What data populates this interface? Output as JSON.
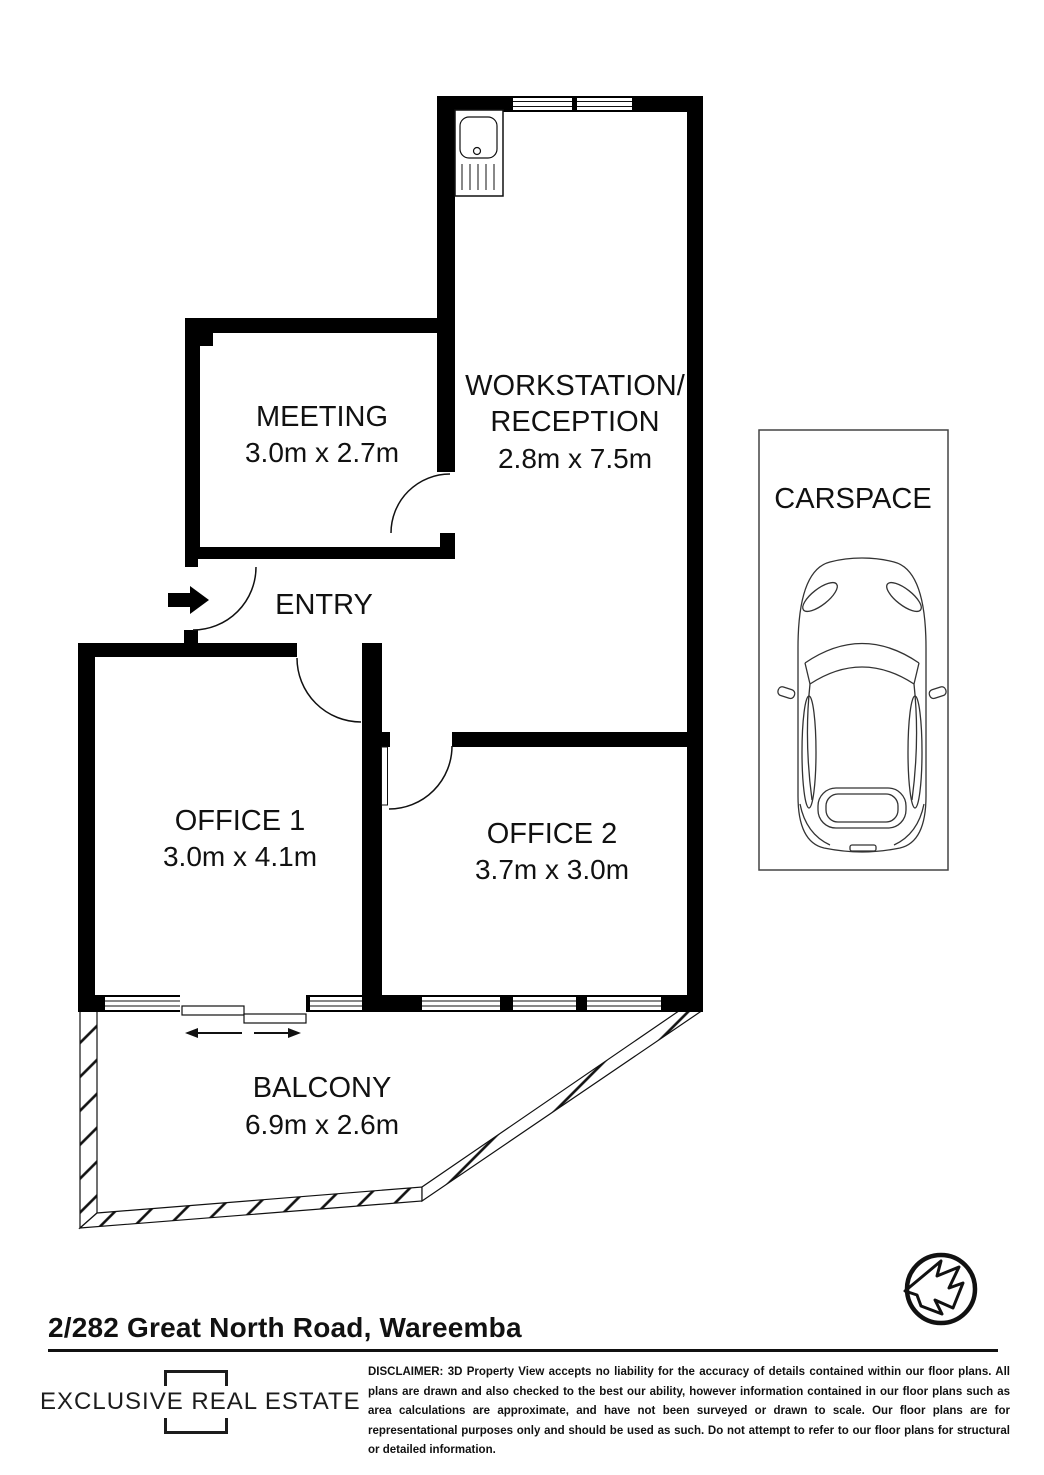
{
  "rooms": {
    "meeting": {
      "label": "MEETING",
      "dims": "3.0m x 2.7m"
    },
    "workstation": {
      "label_line1": "WORKSTATION/",
      "label_line2": "RECEPTION",
      "dims": "2.8m x 7.5m"
    },
    "entry": {
      "label": "ENTRY"
    },
    "office1": {
      "label": "OFFICE 1",
      "dims": "3.0m x 4.1m"
    },
    "office2": {
      "label": "OFFICE 2",
      "dims": "3.7m x 3.0m"
    },
    "balcony": {
      "label": "BALCONY",
      "dims": "6.9m x 2.6m"
    },
    "carspace": {
      "label": "CARSPACE"
    }
  },
  "icons": {
    "north_arrow": "north-arrow",
    "sink": "kitchen-sink",
    "car": "car-top-view",
    "entry_arrow": "entry-direction-arrow",
    "sliding_door_arrows": "sliding-door-direction-arrows"
  },
  "colors": {
    "ink": "#111111",
    "background": "#ffffff"
  },
  "footer": {
    "address": "2/282 Great North Road, Wareemba",
    "logo_text": "EXCLUSIVE REAL ESTATE",
    "disclaimer": "DISCLAIMER: 3D Property View accepts no liability for the accuracy of details contained within our floor plans. All plans are drawn and also checked to the best our ability, however information contained in our floor plans such as area calculations are approximate, and have not been surveyed or drawn to scale. Our floor plans are for representational purposes only and should be used as such. Do not attempt to refer to our floor plans for structural or detailed information."
  }
}
